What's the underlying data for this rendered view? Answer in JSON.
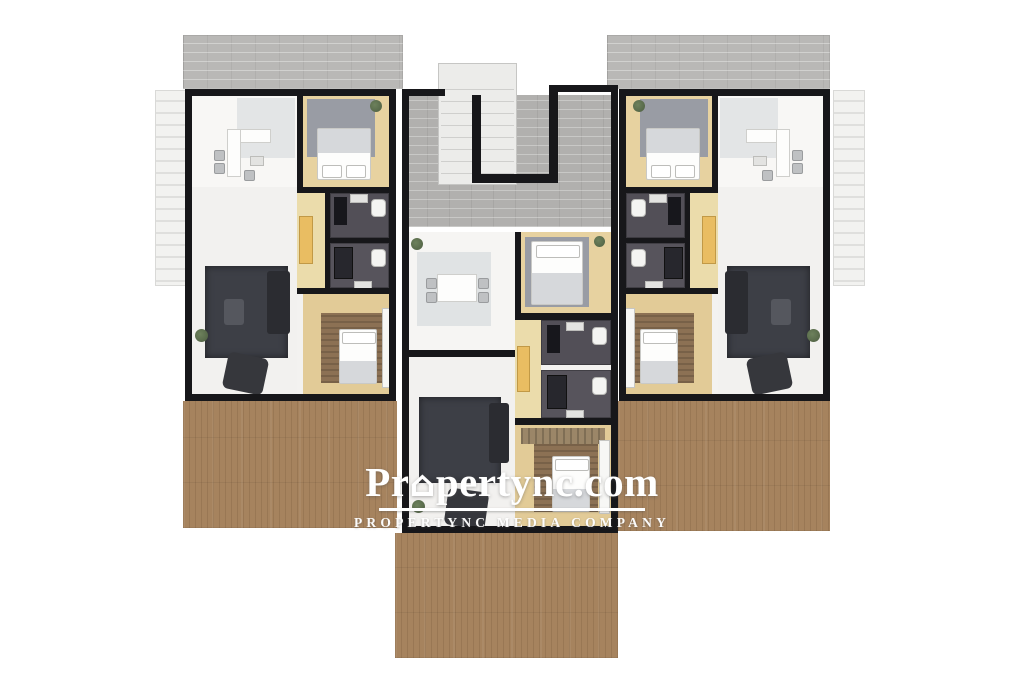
{
  "watermark": {
    "brand_prefix": "Pr",
    "house_icon": "⌂",
    "brand_suffix": "pertync.com",
    "brand_full": "Propertync.com",
    "tagline": "PROPERTYNC MEDIA COMPANY",
    "text_color": "#ffffff"
  },
  "palette": {
    "background": "#ffffff",
    "wall_black": "#17171a",
    "roof_gray": "#b9b8b6",
    "corridor_gray": "#b1b0ae",
    "stair_white": "#ececea",
    "deck_wood": "#a6835e",
    "interior_light": "#f3f2f0",
    "wood_floor": "#e7d2a0",
    "bathroom_dark": "#524f57",
    "rug_dark": "#3d3f46",
    "rug_gray": "#999ca4",
    "rug_brown": "#8c7154",
    "closet_yellow": "#e9bd62"
  },
  "plan": {
    "type": "top-down rendered residential floor plan",
    "units": [
      "left-apartment",
      "center-apartment",
      "right-apartment"
    ],
    "shared": [
      "central-staircase",
      "corridor"
    ],
    "outdoor": [
      "roof-slab-left",
      "roof-slab-right",
      "pergola-strip-left",
      "pergola-strip-right",
      "terrace-deck-left",
      "terrace-deck-right",
      "terrace-deck-bottom"
    ]
  }
}
